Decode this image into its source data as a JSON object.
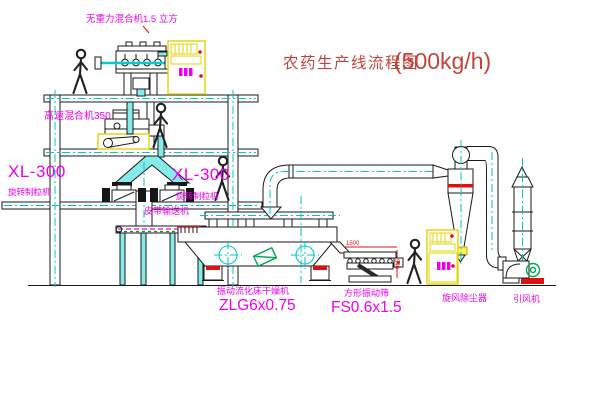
{
  "title": {
    "cn": "农药生产线流程图",
    "rate": "(500kg/h)"
  },
  "labels": {
    "gravity_mixer": "无重力混合机1.5 立方",
    "high_speed_mixer": "高速混合机350",
    "granulator_left_model": "XL-300",
    "granulator_left_name": "旋转制粒机",
    "granulator_right_model": "XL-300",
    "granulator_right_name": "旋转制粒机",
    "belt_conveyor": "皮带输送机",
    "dryer_name": "振动流化床干燥机",
    "dryer_model": "ZLG6x0.75",
    "sieve_name": "方形振动筛",
    "sieve_model": "FS0.6x1.5",
    "cyclone": "旋风除尘器",
    "fan": "引风机"
  },
  "dimensions": {
    "sieve_length": "1500",
    "sieve_height": "540"
  },
  "colors": {
    "label_magenta": "#ee00ee",
    "title_red": "#c2453c",
    "accent_red": "#e01010",
    "pipe_cyan": "#00cfcf",
    "cabinet_yellow": "#e3d400",
    "machine_green": "#00a651",
    "line_black": "#1a1a1a"
  }
}
